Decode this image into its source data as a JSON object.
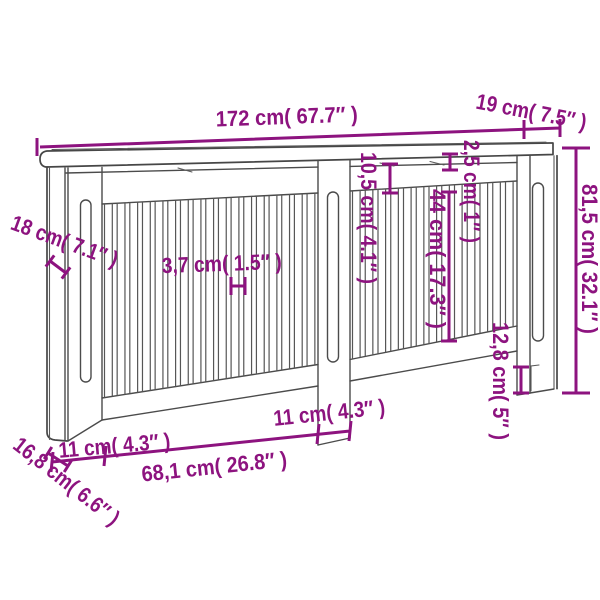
{
  "title": "Radiator cover dimension diagram",
  "colors": {
    "dimension_text": "#8D137F",
    "outline": "#4B4B4B",
    "background": "#FFFFFF"
  },
  "labels": {
    "total_width": "172 cm( 67.7″ )",
    "total_depth": "19 cm( 7.5″ )",
    "total_height": "81,5 cm( 32.1″ )",
    "top_board_thickness": "2,5 cm( 1″ )",
    "top_rail_height": "10,5 cm( 4.1″ )",
    "slat_length": "44 cm( 17.3″ )",
    "side_panel_depth": "18 cm( 7.1″ )",
    "slat_width": "3,7 cm( 1.5″ )",
    "foot_height": "12,8 cm( 5″ )",
    "left_stile_width": "11 cm( 4.3″ )",
    "middle_stile_width": "11 cm( 4.3″ )",
    "bay_width": "68,1 cm( 26.8″ )",
    "foot_depth": "16,8 cm( 6.6″ )"
  },
  "figure": {
    "slat_bays": [
      {
        "count": 17,
        "start": 104.5,
        "pitch": 12.66,
        "slat_width": 7.8,
        "top_edge": [
          102,
          204,
          318,
          193
        ],
        "bottom_edge": [
          102,
          398,
          318,
          364.5
        ]
      },
      {
        "count": 13,
        "start": 352.5,
        "pitch": 12.75,
        "slat_width": 7.6,
        "top_edge": [
          350,
          191,
          517,
          181
        ],
        "bottom_edge": [
          350,
          359.5,
          517,
          326
        ]
      }
    ]
  }
}
